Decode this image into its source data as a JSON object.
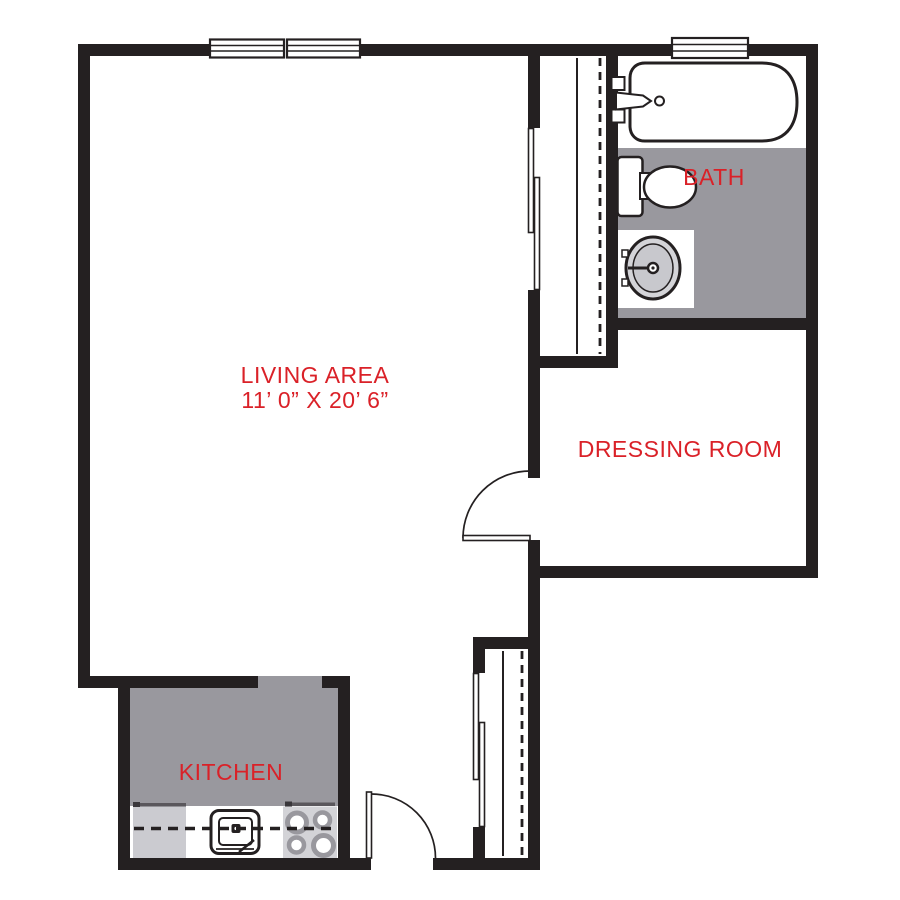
{
  "document": {
    "type": "apartment-floor-plan"
  },
  "colors": {
    "background": "#ffffff",
    "wall": "#242021",
    "floor": "#99989e",
    "red": "#da2128",
    "appliance": "#cbcbd0",
    "stove": "#d3d3d7",
    "sink_fill": "#d4d4d8",
    "sink_inner": "#c8c8cd"
  },
  "rooms": {
    "living": {
      "label": "LIVING AREA",
      "dimensions": "11’ 0” X 20’ 6”",
      "floor_color_key": "background"
    },
    "bath": {
      "label": "BATH",
      "floor_color_key": "floor"
    },
    "dressing": {
      "label": "DRESSING ROOM",
      "floor_color_key": "background"
    },
    "kitchen": {
      "label": "KITCHEN",
      "floor_color_key": "floor"
    }
  },
  "fixtures": {
    "bathtub": "rounded outline tub with faucet, handles and drain",
    "toilet": "tank with oval bowl",
    "bathroom_sink": "oval basin on square vanity with center faucet",
    "kitchen_sink": "double rounded square with faucet block and drainboard line",
    "stove": "four burner rings",
    "refrigerator_counter": "light gray counter block",
    "counter_dashed_line": "dashed centerline through counters",
    "closet_shelf": "solid line",
    "closet_rod": "dashed line",
    "sliding_doors": "offset bypass panels",
    "hinged_doors": "door leaf with quarter-circle swing arc",
    "windows": "triple-line glazing panels in wall"
  }
}
